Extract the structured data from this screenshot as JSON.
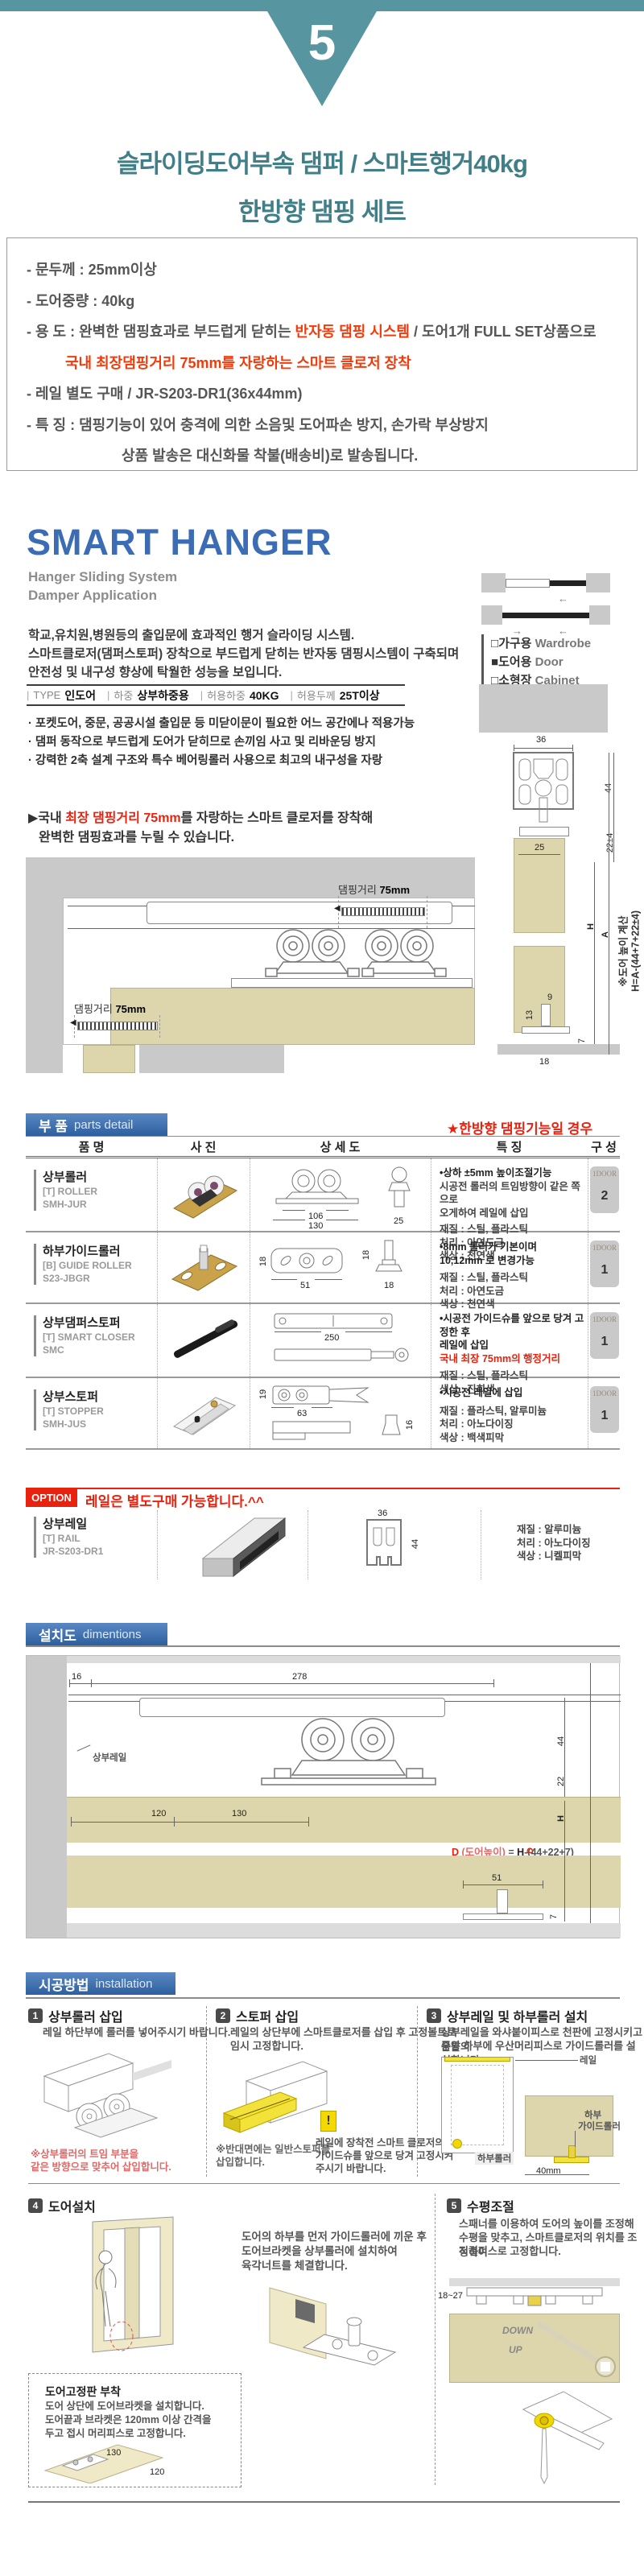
{
  "colors": {
    "teal": "#5796a0",
    "title_teal": "#417f88",
    "brand_blue": "#3b6cb4",
    "header_blue": "#3e6fae",
    "accent_red": "#e8220e",
    "info_red": "#f03c0c",
    "door_beige": "#ddd6ad",
    "wall_gray": "#c9c9c9"
  },
  "header": {
    "step_number": "5",
    "title_line1": "슬라이딩도어부속 댐퍼 / 스마트행거40kg",
    "title_line2": "한방향 댐핑 세트"
  },
  "info_box": {
    "line1": "- 문두께 : 25mm이상",
    "line2": "- 도어중량 : 40kg",
    "line3_prefix": "- 용  도 : 완벽한 댐핑효과로 부드럽게 닫히는 ",
    "line3_red": "반자동 댐핑 시스템",
    "line3_suffix": " / 도어1개 FULL SET상품으로",
    "line4_red": "국내 최장댐핑거리 75mm를 자랑하는 스마트 클로저 장착",
    "line5": "- 레일 별도 구매 / JR-S203-DR1(36x44mm)",
    "line6": "- 특  징 : 댐핑기능이 있어 충격에 의한 소음및 도어파손 방지, 손가락 부상방지",
    "line7": "상품 발송은 대신화물 착불(배송비)로 발송됩니다."
  },
  "brand": {
    "title": "SMART HANGER",
    "subtitle1": "Hanger Sliding System",
    "subtitle2": "Damper Application",
    "desc1": "학교,유치원,병원등의 출입문에 효과적인 행거 슬라이딩 시스템.",
    "desc2": "스마트클로저(댐퍼스토퍼) 장착으로 부드럽게 닫히는 반자동 댐핑시스템이 구축되며",
    "desc3": "안전성 및 내구성 향상에 탁월한 성능을 보입니다.",
    "legend": [
      {
        "symbol": "□",
        "kr": "가구용",
        "en": "Wardrobe"
      },
      {
        "symbol": "■",
        "kr": "도어용",
        "en": "Door"
      },
      {
        "symbol": "□",
        "kr": "소형장",
        "en": "Cabinet"
      }
    ],
    "spec_strip": [
      {
        "label": "TYPE",
        "value": "인도어"
      },
      {
        "label": "하중",
        "value": "상부하중용"
      },
      {
        "label": "허용하중",
        "value": "40KG"
      },
      {
        "label": "허용두께",
        "value": "25T이상"
      }
    ],
    "bullets": [
      "· 포켓도어, 중문, 공공시설 출입문 등 미닫이문이 필요한 어느 공간에나 적용가능",
      "· 댐퍼 동작으로 부드럽게 도어가 닫히므로 손끼임 사고 및 리바운딩 방지",
      "· 강력한 2축 설계 구조와 특수 베어링롤러 사용으로 최고의 내구성을 자랑"
    ],
    "closer_prefix": "▶국내 ",
    "closer_red": "최장 댐핑거리 75mm",
    "closer_suffix": "를 자랑하는 스마트 클로저를 장착해",
    "closer_line2": "완벽한 댐핑효과를 누릴 수 있습니다."
  },
  "section_diagram": {
    "damp_kr": "댐핑거리 ",
    "damp_mm": "75mm",
    "d36": "36",
    "d44": "44",
    "d22": "22±4",
    "d25": "25",
    "d9": "9",
    "d13": "13",
    "d18": "18",
    "d7": "7",
    "dH": "H",
    "dA": "A",
    "note1": "※도어 높이 계산",
    "note2": "H=A-(44+7+22±4)"
  },
  "parts": {
    "header_kr": "부 품",
    "header_en": "parts detail",
    "note_red": "★한방향 댐핑기능일 경우",
    "col1": "품 명",
    "col2": "사 진",
    "col3": "상 세 도",
    "col4": "특 징",
    "col5": "구 성",
    "rows": [
      {
        "name": "상부롤러",
        "code1": "[T] ROLLER",
        "code2": "SMH-JUR",
        "dim1": "106",
        "dim2": "130",
        "dim3": "25",
        "f1": "•상하 ±5mm 높이조절기능",
        "f2": "시공전 롤러의 트임방향이 같은 쪽으로",
        "f3": "오게하여 레일에 삽입",
        "f4": "재질 : 스틸, 플라스틱",
        "f5": "처리 : 아연도금",
        "f6": "색상 : 천연색",
        "badge": "1DOOR",
        "qty": "2"
      },
      {
        "name": "하부가이드롤러",
        "code1": "[B] GUIDE ROLLER",
        "code2": "S23-JBGR",
        "dim1": "18",
        "dim2": "51",
        "dim3": "18",
        "dim4": "18",
        "f1": "•8mm 롤러가 기본이며",
        "f2": "10,12mm 로 변경가능",
        "f3": "재질 : 스틸, 플라스틱",
        "f4": "처리 : 아연도금",
        "f5": "색상 : 천연색",
        "badge": "1DOOR",
        "qty": "1"
      },
      {
        "name": "상부댐퍼스토퍼",
        "code1": "[T] SMART CLOSER",
        "code2": "SMC",
        "dim1": "250",
        "f1": "•시공전 가이드슈를 앞으로 당겨 고정한 후",
        "f2": "레일에 삽입",
        "f3": "국내 최장 75mm의 행정거리",
        "f4": "재질 : 스틸, 플라스틱",
        "f5": "색상 : 진회색",
        "badge": "1DOOR",
        "qty": "1"
      },
      {
        "name": "상부스토퍼",
        "code1": "[T] STOPPER",
        "code2": "SMH-JUS",
        "dim1": "19",
        "dim2": "63",
        "dim3": "16",
        "f1": "•시공전 레일에 삽입",
        "f2": "재질 : 플라스틱, 알루미늄",
        "f3": "처리 : 아노다이징",
        "f4": "색상 : 백색피막",
        "badge": "1DOOR",
        "qty": "1"
      }
    ],
    "option_badge": "OPTION",
    "option_text": "레일은 별도구매 가능합니다.^^",
    "rail_row": {
      "name": "상부레일",
      "code1": "[T] RAIL",
      "code2": "JR-S203-DR1",
      "dim1": "36",
      "dim2": "44",
      "f1": "재질 : 알루미늄",
      "f2": "처리 : 아노다이징",
      "f3": "색상 : 니켈피막"
    }
  },
  "install_diagram": {
    "header_kr": "설치도",
    "header_en": "dimentions",
    "rail_label": "상부레일",
    "d16": "16",
    "d278": "278",
    "d44": "44",
    "d22": "22",
    "dH": "H",
    "d120": "120",
    "d130": "130",
    "d51": "51",
    "d7": "7",
    "dD": "D",
    "f_d": "D",
    "f_paren": " (도어높이)",
    "f_eq": " = ",
    "f_h": "H",
    "f_rest": "-(44+22+7)"
  },
  "steps": {
    "header_kr": "시공방법",
    "header_en": "installation",
    "s1_num": "1",
    "s1_title": "상부롤러 삽입",
    "s1_desc": "레일 하단부에 롤러를 넣어주시기 바랍니다.",
    "s1_note1": "※상부롤러의 트임 부분을",
    "s1_note2": "  같은 방향으로 맞추어 삽입합니다.",
    "s2_num": "2",
    "s2_title": "스토퍼 삽입",
    "s2_desc1": "레일의 상단부에 스마트클로저를 삽입 후 고정볼트로",
    "s2_desc2": "임시 고정합니다.",
    "s2_note1": "※반대면에는 일반스토퍼를",
    "s2_note2": "  삽입합니다.",
    "s2_bang": "!",
    "s2_warn1": "레일에 장착전 스마트 클로저의",
    "s2_warn2": "가이드슈를 앞으로 당겨 고정시켜",
    "s2_warn3": "주시기 바랍니다.",
    "s3_num": "3",
    "s3_title": "상부레일 및 하부롤러 설치",
    "s3_desc1": "상부레일을 와샤붙이피스로 천판에 고정시키고 문틀의",
    "s3_desc2": "중앙 하부에 우산머리피스로 가이드롤러를 설치합니다.",
    "s3_label_rail": "레일",
    "s3_label_broller": "하부롤러",
    "s3_label_g1": "하부",
    "s3_label_g2": "가이드롤러",
    "s3_dim": "40mm",
    "s4_num": "4",
    "s4_title": "도어설치",
    "s4_desc1": "도어의 하부를 먼저 가이드롤러에 끼운 후",
    "s4_desc2": "도어브라켓을 상부롤러에 설치하여",
    "s4_desc3": "육각너트를 체결합니다.",
    "s4_box_title": "도어고정판 부착",
    "s4_box_l1": "도어 상단에 도어브라켓을 설치합니다.",
    "s4_box_l2": "도어끝과 브라켓은 120mm 이상 간격을",
    "s4_box_l3": "두고 접시 머리피스로 고정합니다.",
    "s4_dim1": "130",
    "s4_dim2": "120",
    "s5_num": "5",
    "s5_title": "수평조절",
    "s5_desc1": "스패너를 이용하여 도어의 높이를 조정해",
    "s5_desc2": "수평을 맞추고, 스마트클로저의 위치를 조정하여",
    "s5_desc3": "직결피스로 고정합니다.",
    "s5_dim": "18~27",
    "s5_down": "DOWN",
    "s5_up": "UP"
  }
}
